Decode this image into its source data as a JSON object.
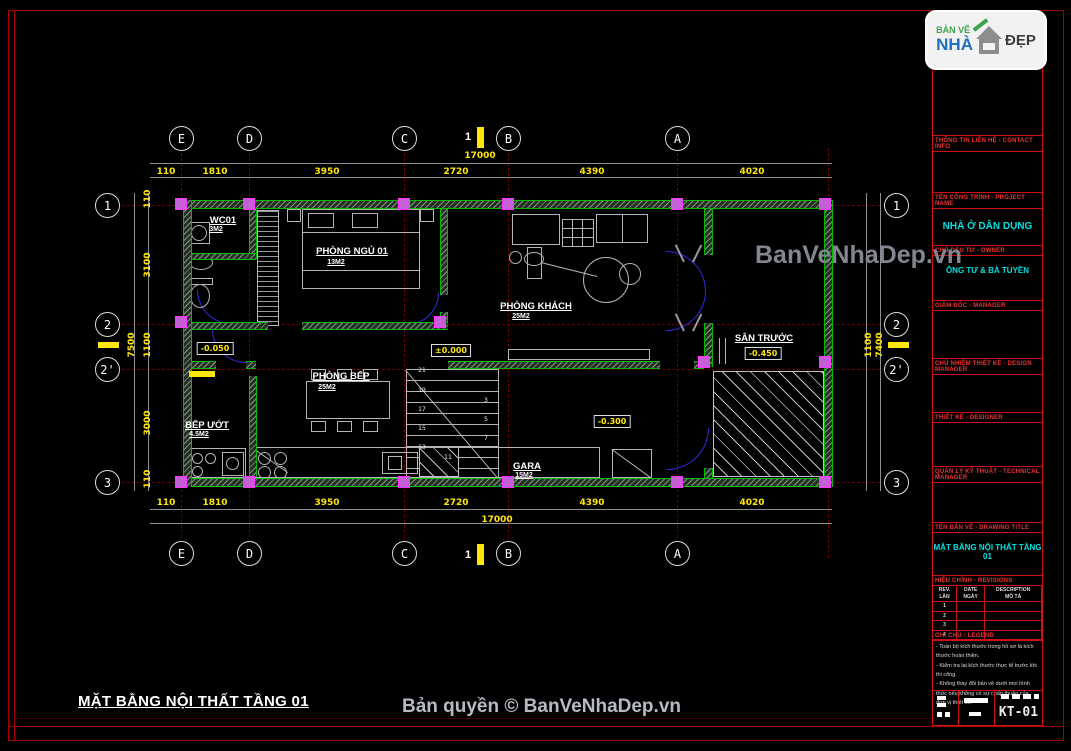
{
  "watermark": "BanVeNhaDep.vn",
  "footer": {
    "drawing_title": "MẶT BẰNG NỘI THẤT TẦNG 01",
    "copyright": "Bản quyền © BanVeNhaDep.vn"
  },
  "logo": {
    "ban_ve": "BẢN VẼ",
    "nha": "NHÀ",
    "dep": "ĐẸP"
  },
  "grids": {
    "cols": [
      {
        "label": "E"
      },
      {
        "label": "D"
      },
      {
        "label": "C"
      },
      {
        "label": "B"
      },
      {
        "label": "A"
      }
    ],
    "rows": [
      {
        "label": "1"
      },
      {
        "label": "2"
      },
      {
        "label": "2'"
      },
      {
        "label": "3"
      }
    ]
  },
  "section_marker": "1",
  "dims": {
    "top": [
      "110",
      "1810",
      "3950",
      "2720",
      "4390",
      "4020"
    ],
    "top_total": "17000",
    "bottom": [
      "110",
      "1810",
      "3950",
      "2720",
      "4390",
      "4020"
    ],
    "bottom_total": "17000",
    "left": [
      "110",
      "3100",
      "1100",
      "3000",
      "110"
    ],
    "left_total": "7500",
    "right": [
      "1100",
      "7400"
    ]
  },
  "rooms": {
    "wc": {
      "name": "WC01",
      "area": "3M2"
    },
    "bedroom": {
      "name": "PHÒNG NGỦ 01",
      "area": "13M2"
    },
    "living": {
      "name": "PHÒNG KHÁCH",
      "area": "25M2"
    },
    "yard": {
      "name": "SÂN TRƯỚC"
    },
    "wetkitchen": {
      "name": "BẾP ƯỚT",
      "area": "4.5M2"
    },
    "kitchen": {
      "name": "PHÒNG BẾP",
      "area": "25M2"
    },
    "garage": {
      "name": "GARA",
      "area": "15M2"
    }
  },
  "levels": {
    "hall": "-0.050",
    "kitchen": "±0.000",
    "yard": "-0.450",
    "garage": "-0.300"
  },
  "stairs": {
    "numbers": [
      "21",
      "19",
      "17",
      "15",
      "13",
      "11",
      "3",
      "5",
      "7"
    ]
  },
  "titleblock": {
    "s1": "TƯ VẤN - CONSULTANT",
    "s2": "THÔNG TIN LIÊN HỆ - CONTACT INFO",
    "s3": "TÊN CÔNG TRÌNH - PROJECT NAME",
    "project": "NHÀ Ở DÂN DỤNG",
    "s4": "CHỦ ĐẦU TƯ - OWNER",
    "owner": "ÔNG TƯ & BÀ TUYỀN",
    "s5": "GIÁM ĐỐC - MANAGER",
    "s6": "CHỦ NHIỆM THIẾT KẾ - DESIGN MANAGER",
    "s7": "THIẾT KẾ - DESIGNER",
    "s8": "QUẢN LÝ KỸ THUẬT - TECHNICAL MANAGER",
    "s9": "TÊN BẢN VẼ - DRAWING TITLE",
    "drawing_title": "MẶT BẰNG NỘI THẤT TẦNG 01",
    "s10": "HIỆU CHỈNH - REVISIONS",
    "rev_cols": [
      {
        "en": "REV.",
        "vi": "LẦN"
      },
      {
        "en": "DATE",
        "vi": "NGÀY"
      },
      {
        "en": "DESCRIPTION",
        "vi": "MÔ TẢ"
      }
    ],
    "rev_rows": [
      "1",
      "2",
      "3",
      "4"
    ],
    "s11": "GHI CHÚ - LEGEND",
    "notes": [
      "- Toàn bộ kích thước trong hồ sơ là kích thước hoàn thiện.",
      "- Kiểm tra lại kích thước thực tế trước khi thi công.",
      "- Không thay đổi bản vẽ dưới mọi hình thức nếu không có sự chấp thuận của đơn vị thiết kế."
    ],
    "sheet_no": "KT-01"
  },
  "colors": {
    "frame_red": "#a40000",
    "axis_red": "#6b0000",
    "wall_green": "#00bb00",
    "column_magenta": "#ff33ff",
    "dimension_yellow": "#ffe60a",
    "door_blue": "#2d2de0",
    "title_cyan": "#00e0e0",
    "header_red": "#ee3333",
    "watermark_gray": "#82878f"
  }
}
